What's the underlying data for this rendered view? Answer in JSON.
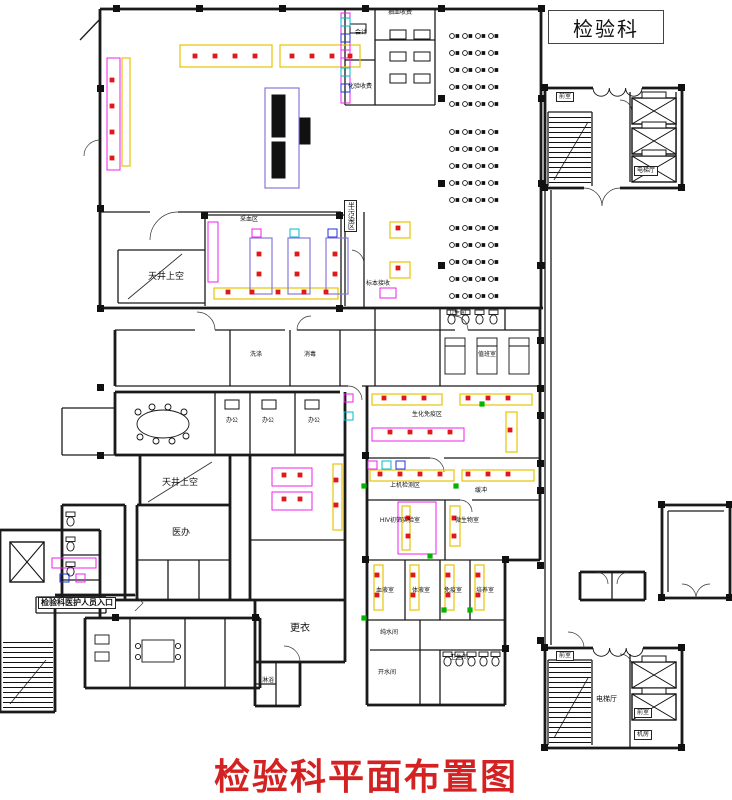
{
  "window": {
    "legend_label": "检验科",
    "main_title": "检验科平面布置图"
  },
  "palette": {
    "wall": "#1a1a1a",
    "bench_yellow": "#e6c400",
    "casework_pink": "#ee22ee",
    "equipment_red": "#e01818",
    "pass_green": "#00b400",
    "accent_blue": "#2233dd",
    "bench_purple": "#8877dd",
    "title_red": "#d42222",
    "cyan": "#00bbcc"
  },
  "plan": {
    "labels": [
      {
        "text": "天井上空",
        "x": 148,
        "y": 272,
        "size": 9
      },
      {
        "text": "天井上空",
        "x": 162,
        "y": 478,
        "size": 9
      },
      {
        "text": "医办",
        "x": 172,
        "y": 528,
        "size": 9
      },
      {
        "text": "更衣",
        "x": 290,
        "y": 624,
        "size": 10
      },
      {
        "text": "检验科医护人员入口",
        "x": 38,
        "y": 597,
        "size": 8,
        "bold": true,
        "boxed": true
      },
      {
        "text": "卫生间",
        "x": 448,
        "y": 311,
        "size": 6
      },
      {
        "text": "卫生间",
        "x": 450,
        "y": 655,
        "size": 6
      },
      {
        "text": "半污染区",
        "x": 344,
        "y": 200,
        "size": 7,
        "boxed": true,
        "vert": true
      },
      {
        "text": "采血区",
        "x": 240,
        "y": 217,
        "size": 6
      },
      {
        "text": "抽血收费",
        "x": 388,
        "y": 10,
        "size": 6
      },
      {
        "text": "会计",
        "x": 355,
        "y": 30,
        "size": 6
      },
      {
        "text": "化验收费",
        "x": 348,
        "y": 84,
        "size": 6
      },
      {
        "text": "标本接收",
        "x": 366,
        "y": 281,
        "size": 6
      },
      {
        "text": "值班室",
        "x": 478,
        "y": 352,
        "size": 6
      },
      {
        "text": "洗涤",
        "x": 250,
        "y": 352,
        "size": 6
      },
      {
        "text": "消毒",
        "x": 304,
        "y": 352,
        "size": 6
      },
      {
        "text": "办公",
        "x": 226,
        "y": 418,
        "size": 6
      },
      {
        "text": "办公",
        "x": 262,
        "y": 418,
        "size": 6
      },
      {
        "text": "办公",
        "x": 308,
        "y": 418,
        "size": 6
      },
      {
        "text": "生化免疫区",
        "x": 412,
        "y": 412,
        "size": 6
      },
      {
        "text": "上机检测区",
        "x": 390,
        "y": 483,
        "size": 6
      },
      {
        "text": "缓冲",
        "x": 475,
        "y": 488,
        "size": 6
      },
      {
        "text": "HIV初筛实验室",
        "x": 380,
        "y": 518,
        "size": 6
      },
      {
        "text": "微生物室",
        "x": 455,
        "y": 518,
        "size": 6
      },
      {
        "text": "血液室",
        "x": 376,
        "y": 588,
        "size": 6
      },
      {
        "text": "体液室",
        "x": 412,
        "y": 588,
        "size": 6
      },
      {
        "text": "免疫室",
        "x": 444,
        "y": 588,
        "size": 6
      },
      {
        "text": "培养室",
        "x": 476,
        "y": 588,
        "size": 6
      },
      {
        "text": "纯水间",
        "x": 380,
        "y": 630,
        "size": 6
      },
      {
        "text": "开水间",
        "x": 378,
        "y": 670,
        "size": 6
      },
      {
        "text": "淋浴",
        "x": 262,
        "y": 678,
        "size": 6
      },
      {
        "text": "电梯厅",
        "x": 596,
        "y": 696,
        "size": 7
      },
      {
        "text": "前室",
        "x": 556,
        "y": 92,
        "size": 6,
        "boxed": true
      },
      {
        "text": "电梯厅",
        "x": 634,
        "y": 166,
        "size": 6,
        "boxed": true
      },
      {
        "text": "前室",
        "x": 556,
        "y": 651,
        "size": 6,
        "boxed": true
      },
      {
        "text": "前室",
        "x": 634,
        "y": 708,
        "size": 6,
        "boxed": true
      },
      {
        "text": "机房",
        "x": 634,
        "y": 730,
        "size": 6,
        "boxed": true
      }
    ]
  }
}
